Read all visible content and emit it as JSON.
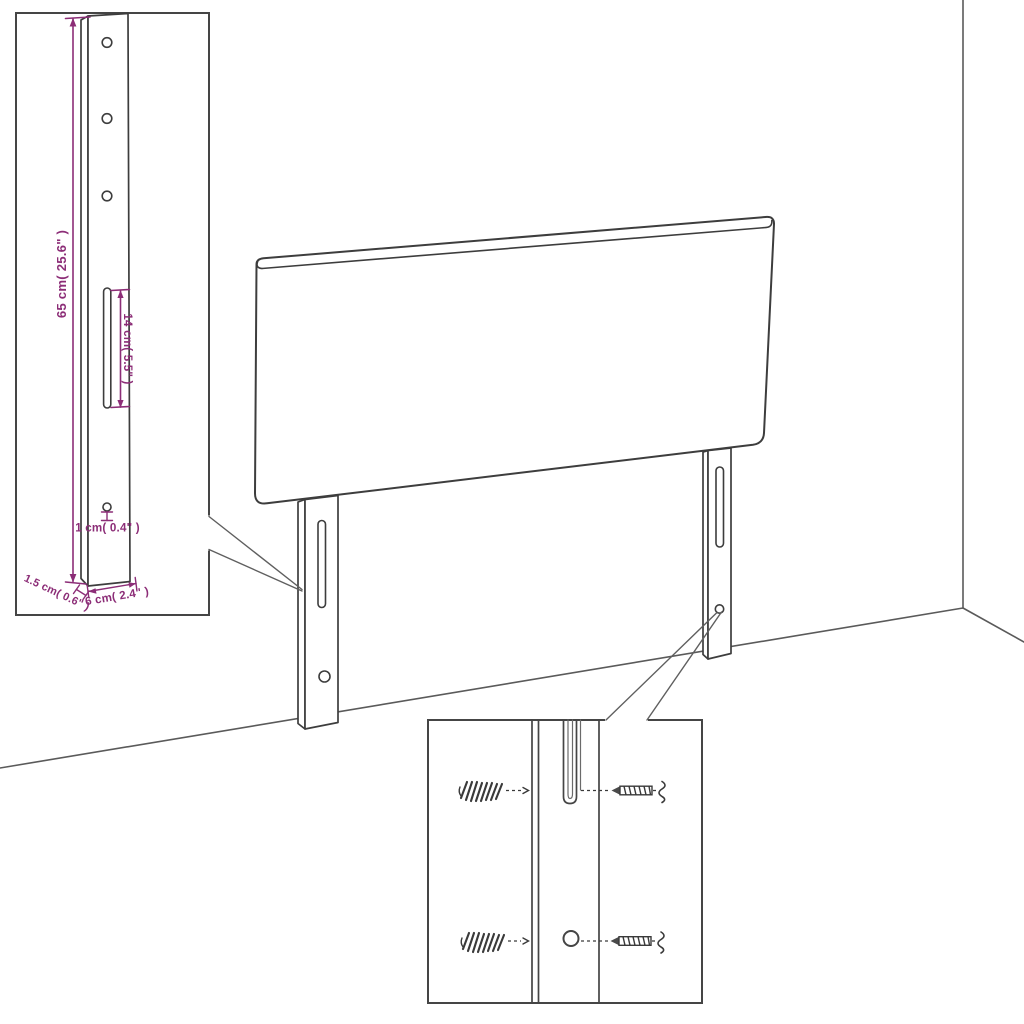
{
  "diagram": {
    "subject": "headboard-dimension-diagram",
    "dimension_labels": {
      "leg_height": "65 cm( 25.6\" )",
      "slot_length": "14 cm( 5.5\" )",
      "hole_diameter": "1 cm( 0.4\" )",
      "leg_thickness": "1.5 cm( 0.6\" )",
      "leg_width": "6 cm( 2.4\" )"
    },
    "colors": {
      "dimension": "#8C2D77",
      "outline": "#3D3D3D",
      "background": "#FFFFFF"
    }
  }
}
